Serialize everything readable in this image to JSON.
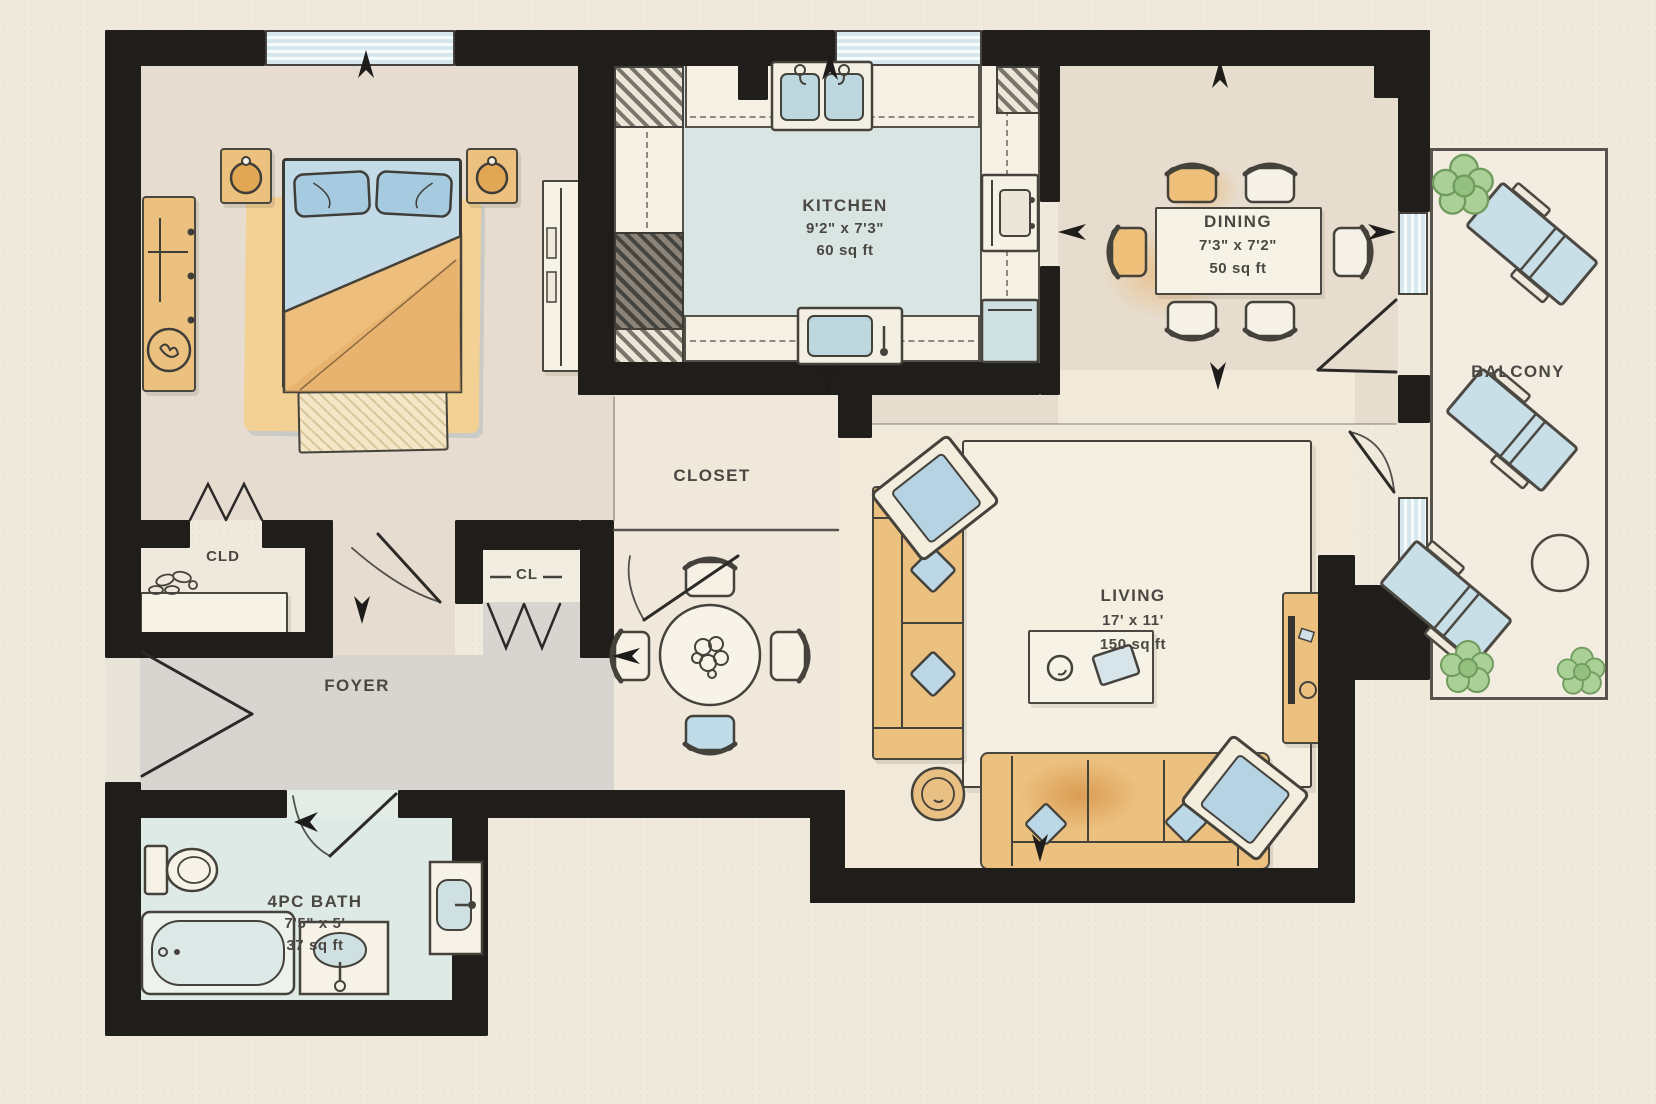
{
  "rooms": {
    "kitchen": {
      "name": "KITCHEN",
      "dims": "9'2\" x 7'3\"",
      "area": "60 sq ft"
    },
    "dining": {
      "name": "DINING",
      "dims": "7'3\" x 7'2\"",
      "area": "50 sq ft"
    },
    "living": {
      "name": "LIVING",
      "dims": "17' x 11'",
      "area": "150 sq ft"
    },
    "bath": {
      "name": "4PC BATH",
      "dims": "7'5\" x 5'",
      "area": "37 sq ft"
    },
    "foyer": {
      "name": "FOYER"
    },
    "balcony": {
      "name": "BALCONY"
    },
    "closet": {
      "name": "CLOSET"
    },
    "closet_cld": {
      "name": "CLD"
    },
    "closet_cl": {
      "name": "CL"
    }
  },
  "colors": {
    "wall": "#201e1b",
    "paper": "#f0eadd",
    "bedroom_floor": "#e6dccf",
    "dining_floor": "#e7ddcf",
    "living_floor": "#f1e9da",
    "foyer_floor": "#d8d5d0",
    "kitchen_floor": "#d9e5e3",
    "bath_floor": "#deeae5",
    "furniture_orange": "#ecc07f",
    "fabric_blue": "#b5d3e3",
    "window_blue": "#d6e8ee",
    "plant_green": "#aacf97"
  }
}
